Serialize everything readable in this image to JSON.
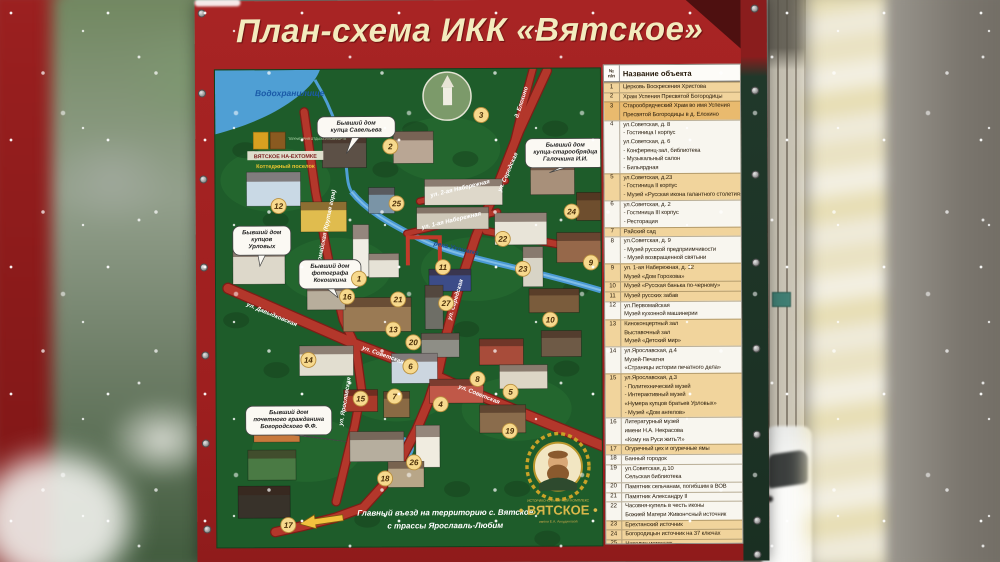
{
  "title": "План-схема ИКК «Вятское»",
  "colors": {
    "frame_red": "#a82424",
    "title_cream": "#f3ebbe",
    "map_green": "#1e5c2a",
    "road_red": "#b3372b",
    "water_blue": "#4f9fd4",
    "legend_yellow": "#f1d49c",
    "legend_orange": "#e9ba6e",
    "marker_yellow": "#f7d98d",
    "brand_gold": "#d9b84a"
  },
  "legend": {
    "header": {
      "num_top": "№",
      "num_bottom": "п/п",
      "name": "Название объекта"
    },
    "entries": [
      {
        "n": "1",
        "tone": "y",
        "lines": [
          "Церковь Воскресения Христова"
        ]
      },
      {
        "n": "2",
        "tone": "y",
        "lines": [
          "Храм Успения Пресвятой Богородицы"
        ]
      },
      {
        "n": "3",
        "tone": "o",
        "lines": [
          "Старообрядческий Храм во имя Успения",
          "Пресвятой Богородицы в д. Елохино"
        ]
      },
      {
        "n": "4",
        "tone": "w",
        "lines": [
          "ул.Советская, д. 8",
          "- Гостиница I корпус",
          "ул.Советская, д. 6",
          "- Конференц-зал, библиотека",
          "- Музыкальный салон",
          "- Бильярдная"
        ]
      },
      {
        "n": "5",
        "tone": "y",
        "lines": [
          "ул.Советская, д.23",
          "- Гостиница II корпус",
          "- Музей «Русская икона галантного столетия»"
        ]
      },
      {
        "n": "6",
        "tone": "w",
        "lines": [
          "ул.Советская, д. 2",
          "- Гостиница III корпус",
          "- Ресторация"
        ]
      },
      {
        "n": "7",
        "tone": "y",
        "lines": [
          "Райский сад"
        ]
      },
      {
        "n": "8",
        "tone": "w",
        "lines": [
          "ул.Советская, д. 9",
          "- Музей русской предприимчивости",
          "- Музей возвращенной святыни"
        ]
      },
      {
        "n": "9",
        "tone": "y",
        "lines": [
          "ул. 1-ая Набережная, д. 12",
          "Музей «Дом Горохова»"
        ]
      },
      {
        "n": "10",
        "tone": "y",
        "lines": [
          "Музей «Русская банька по-черному»"
        ]
      },
      {
        "n": "11",
        "tone": "y",
        "lines": [
          "Музей русских забав"
        ]
      },
      {
        "n": "12",
        "tone": "w",
        "lines": [
          "ул.Первомайская",
          "Музей кухонной машинерии"
        ]
      },
      {
        "n": "13",
        "tone": "y",
        "lines": [
          "Киноконцертный зал",
          "Выставочный зал",
          "Музей «Детский мир»"
        ]
      },
      {
        "n": "14",
        "tone": "w",
        "lines": [
          "ул.Ярославская, д.4",
          "Музей-Печатня",
          "«Страницы истории печатного дела»"
        ]
      },
      {
        "n": "15",
        "tone": "y",
        "lines": [
          "ул.Ярославская, д.3",
          "- Политехнический музей",
          "- Интерактивный музей",
          "«Нумера купцов братьев Урловых»",
          "- Музей «Дом ангелов»"
        ]
      },
      {
        "n": "16",
        "tone": "w",
        "lines": [
          "Литературный музей",
          "имени Н.А. Некрасова",
          "«Кому на Руси жить?!»"
        ]
      },
      {
        "n": "17",
        "tone": "y",
        "lines": [
          "Огуречный цех и огуречные ямы"
        ]
      },
      {
        "n": "18",
        "tone": "w",
        "lines": [
          "Банный городок"
        ]
      },
      {
        "n": "19",
        "tone": "w",
        "lines": [
          "ул.Советская, д.10",
          "Сельская библиотека"
        ]
      },
      {
        "n": "20",
        "tone": "w",
        "lines": [
          "Памятник сельчанам, погибшим в ВОВ"
        ]
      },
      {
        "n": "21",
        "tone": "w",
        "lines": [
          "Памятник Александру II"
        ]
      },
      {
        "n": "22",
        "tone": "w",
        "lines": [
          "Часовня-купель в честь иконы",
          "Божией Матери Живоносный источник"
        ]
      },
      {
        "n": "23",
        "tone": "y",
        "lines": [
          "Ерехтанский источник"
        ]
      },
      {
        "n": "24",
        "tone": "y",
        "lines": [
          "Богородицын источник на 37 ключах"
        ]
      },
      {
        "n": "25",
        "tone": "y",
        "lines": [
          "Николин источник"
        ]
      },
      {
        "n": "26",
        "tone": "w",
        "lines": [
          "Пантелеймонов источник"
        ]
      },
      {
        "n": "27",
        "tone": "y",
        "lines": [
          "Летняя эстрада"
        ]
      }
    ]
  },
  "map": {
    "water_label": {
      "text": "Водохранилище",
      "x": 40,
      "y": 26
    },
    "river_label": {
      "text": "река Ухтомка",
      "x": 240,
      "y": 181,
      "angle": 13
    },
    "cottage_block": {
      "badge": "ТЕРРИТОРИЯ ОТДЫХА И КОМФОРТА",
      "name": "ВЯТСКОЕ НА-ЕХТОМКЕ",
      "sub": "Коттеджный поселок"
    },
    "streets": [
      {
        "text": "ул. Первомайская (Крутая гора)",
        "x": 110,
        "y": 168,
        "angle": -78
      },
      {
        "text": "ул. Давыдковская",
        "x": 55,
        "y": 246,
        "angle": 23
      },
      {
        "text": "ул. Советская",
        "x": 166,
        "y": 287,
        "angle": 20
      },
      {
        "text": "ул. Советская",
        "x": 262,
        "y": 327,
        "angle": 22
      },
      {
        "text": "ул. Ярославская",
        "x": 130,
        "y": 332,
        "angle": -80
      },
      {
        "text": "ул. Середская",
        "x": 294,
        "y": 104,
        "angle": -66
      },
      {
        "text": "ул. Середская",
        "x": 241,
        "y": 231,
        "angle": -73
      },
      {
        "text": "ул. 2-ая Набережная",
        "x": 245,
        "y": 121,
        "angle": -13
      },
      {
        "text": "ул. 1-ая Набережная",
        "x": 236,
        "y": 153,
        "angle": -13
      },
      {
        "text": "д. Елохино",
        "x": 308,
        "y": 34,
        "angle": -72
      }
    ],
    "callouts": [
      {
        "lines": [
          "Бывший дом",
          "купца Савельева"
        ],
        "cx": 141,
        "top": 47,
        "w": 78,
        "h": 21,
        "tail": [
          131,
          84
        ]
      },
      {
        "lines": [
          "Бывший дом",
          "купца-старообрядца",
          "Галочкина И.И."
        ],
        "cx": 350,
        "top": 70,
        "w": 80,
        "h": 29,
        "tail": [
          334,
          104
        ]
      },
      {
        "lines": [
          "Бывший дом",
          "купцов",
          "Урловых"
        ],
        "cx": 46,
        "top": 156,
        "w": 58,
        "h": 29,
        "tail": [
          44,
          196
        ]
      },
      {
        "lines": [
          "Бывший дом",
          "фотографа",
          "Кокошкина"
        ],
        "cx": 114,
        "top": 190,
        "w": 62,
        "h": 29,
        "tail": [
          122,
          228
        ]
      },
      {
        "lines": [
          "Бывший дом",
          "почетного гражданина",
          "Богородского Ф.Ф."
        ],
        "cx": 72,
        "top": 336,
        "w": 86,
        "h": 29,
        "tail": [
          130,
          372
        ]
      }
    ],
    "markers": [
      {
        "n": "12",
        "x": 63,
        "y": 136
      },
      {
        "n": "2",
        "x": 175,
        "y": 77
      },
      {
        "n": "3",
        "x": 266,
        "y": 46
      },
      {
        "n": "25",
        "x": 181,
        "y": 134
      },
      {
        "n": "24",
        "x": 356,
        "y": 143
      },
      {
        "n": "22",
        "x": 287,
        "y": 170
      },
      {
        "n": "9",
        "x": 375,
        "y": 194
      },
      {
        "n": "23",
        "x": 307,
        "y": 200
      },
      {
        "n": "11",
        "x": 227,
        "y": 198
      },
      {
        "n": "1",
        "x": 143,
        "y": 209
      },
      {
        "n": "16",
        "x": 131,
        "y": 227
      },
      {
        "n": "21",
        "x": 182,
        "y": 230
      },
      {
        "n": "27",
        "x": 230,
        "y": 234
      },
      {
        "n": "10",
        "x": 334,
        "y": 251
      },
      {
        "n": "13",
        "x": 177,
        "y": 260
      },
      {
        "n": "20",
        "x": 197,
        "y": 273
      },
      {
        "n": "14",
        "x": 92,
        "y": 290
      },
      {
        "n": "6",
        "x": 194,
        "y": 297
      },
      {
        "n": "8",
        "x": 261,
        "y": 310
      },
      {
        "n": "5",
        "x": 294,
        "y": 323
      },
      {
        "n": "15",
        "x": 144,
        "y": 329
      },
      {
        "n": "7",
        "x": 178,
        "y": 327
      },
      {
        "n": "4",
        "x": 224,
        "y": 335
      },
      {
        "n": "19",
        "x": 293,
        "y": 362
      },
      {
        "n": "26",
        "x": 197,
        "y": 393
      },
      {
        "n": "18",
        "x": 168,
        "y": 409
      },
      {
        "n": "17",
        "x": 71,
        "y": 455
      }
    ],
    "entrance_note": {
      "line1": "Главный въезд на территорию с. Вятское",
      "line2": "с трассы Ярославль-Любим",
      "x": 228,
      "y": 446
    },
    "brand": {
      "top": "ИСТОРИКО-КУЛЬТУРНЫЙ КОМПЛЕКС",
      "name": "• ВЯТСКОЕ •",
      "sub": "имени Е.А. Анкудиновой",
      "cx": 341,
      "cy": 398
    }
  }
}
